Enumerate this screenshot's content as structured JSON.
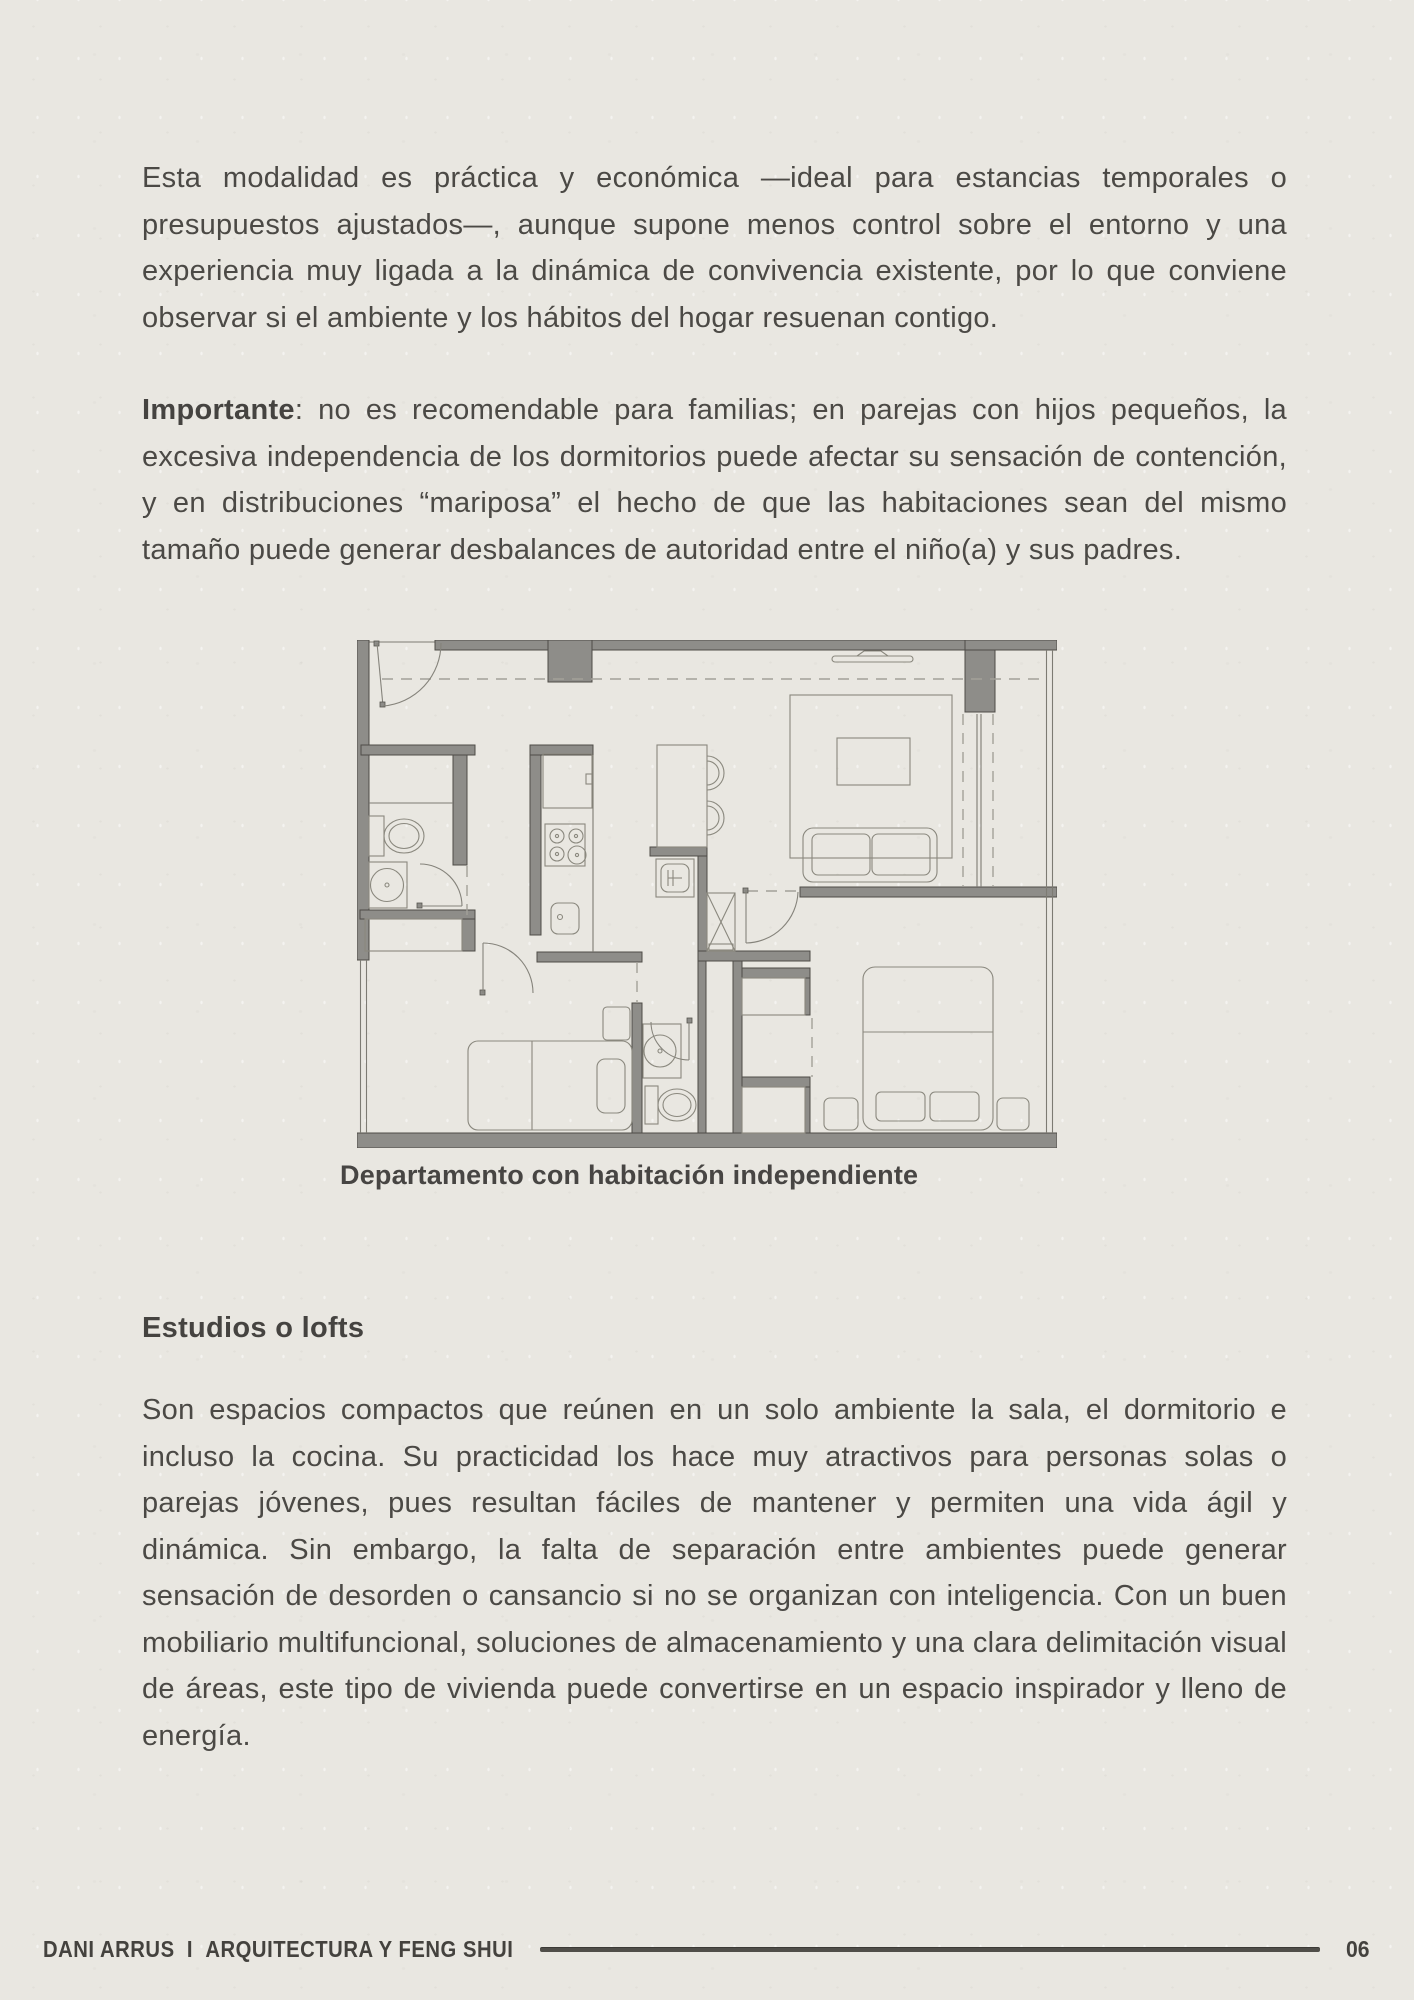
{
  "page": {
    "background_color": "#e9e7e1",
    "text_color": "#4b4945",
    "wall_color": "#8e8d89"
  },
  "content": {
    "paragraph_intro": "Esta modalidad es práctica y económica —ideal para estancias temporales o presupuestos ajustados—, aunque supone menos control sobre el entorno y una experiencia muy ligada a la dinámica de convivencia existente, por lo que conviene observar si el ambiente y los hábitos del hogar resuenan contigo.",
    "important": {
      "label": "Importante",
      "text": ": no es recomendable para familias; en parejas con hijos pequeños, la excesiva independencia de los dormitorios puede afectar su sensación de contención, y en distribuciones “mariposa” el hecho de que las habitaciones sean del mismo tamaño puede generar desbalances de autoridad entre el niño(a) y sus padres."
    },
    "figure": {
      "caption": "Departamento con habitación independiente",
      "type": "apartment-floor-plan",
      "depicted_elements": [
        "entry-door",
        "bathroom-1",
        "toilet",
        "round-washbasin",
        "kitchen-counter",
        "refrigerator",
        "stove",
        "kitchen-sink",
        "island-bar",
        "bar-stools",
        "washing-machine",
        "shelved-closet",
        "tv",
        "living-rug",
        "coffee-table",
        "sofa",
        "master-bed",
        "pillows",
        "nightstands",
        "wardrobes",
        "bathroom-2",
        "single-bed",
        "independent-bedroom",
        "window-walls"
      ]
    },
    "section": {
      "heading": "Estudios o lofts",
      "paragraph": "Son espacios compactos que reúnen en un solo ambiente la sala, el dormitorio e incluso la cocina. Su practicidad los hace muy atractivos para personas solas o parejas jóvenes, pues resultan fáciles de mantener y permiten una vida ágil y dinámica. Sin embargo, la falta de separación entre ambientes puede generar sensación de desorden o cansancio si no se organizan con inteligencia. Con un buen mobiliario multifuncional, soluciones de almacenamiento y una clara delimitación visual de áreas, este tipo de vivienda puede convertirse en un espacio inspirador y lleno de energía."
    }
  },
  "footer": {
    "author": "DANI ARRUS",
    "separator": "I",
    "title": "ARQUITECTURA  Y  FENG SHUI",
    "page_number": "06"
  }
}
